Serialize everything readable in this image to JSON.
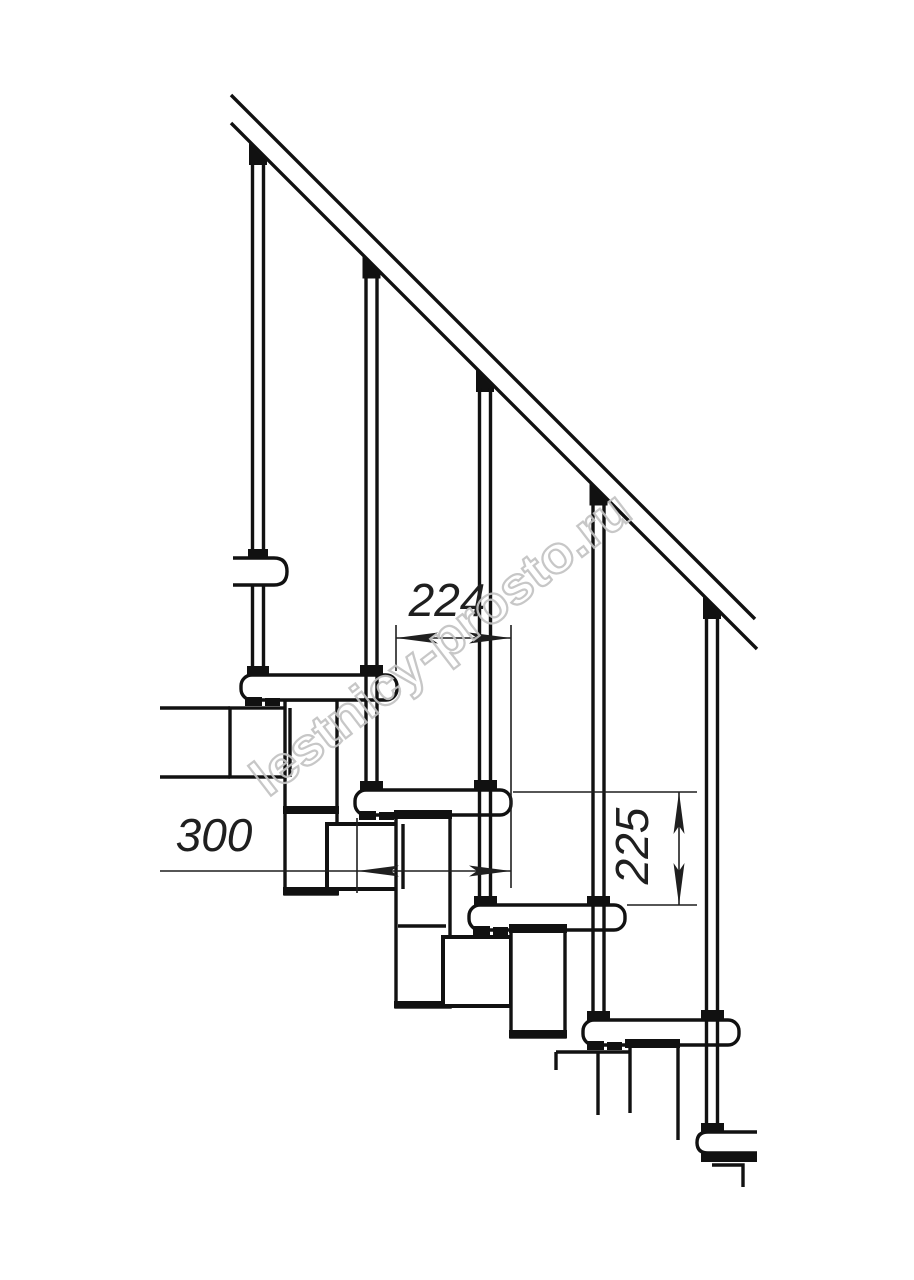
{
  "drawing": {
    "kind": "modular-staircase-fragment-side-view",
    "dimensions": {
      "step_run": "224",
      "tread_depth": "300",
      "riser_height": "225"
    },
    "watermark": {
      "text": "lestnicy-prosto.ru"
    },
    "colors": {
      "ink": "#111111",
      "dim_lines": "#1f1f1f",
      "watermark": "#c3c3c3",
      "paper": "#ffffff"
    }
  }
}
